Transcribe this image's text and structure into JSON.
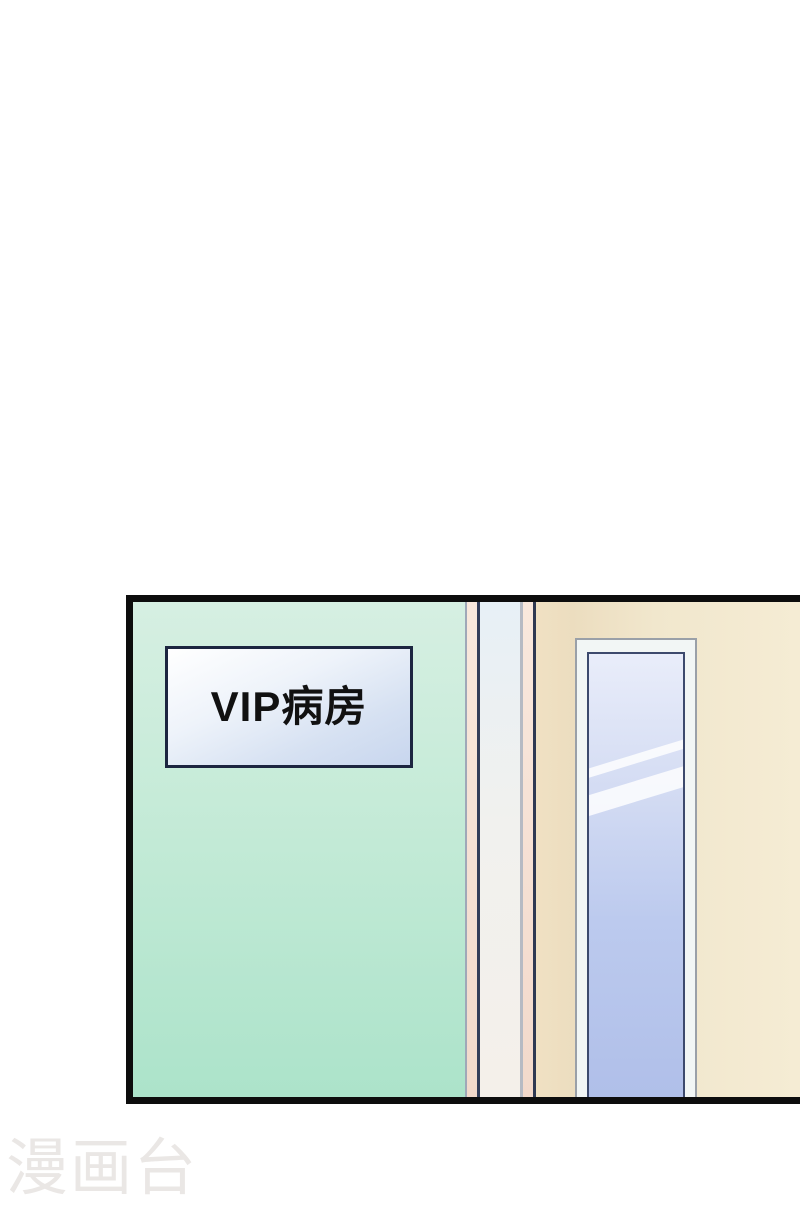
{
  "panel": {
    "type": "manga-panel",
    "scene": "hospital corridor with ward door",
    "border_color": "#0d0d0d",
    "wall": {
      "color_top": "#d6efe2",
      "color_bottom": "#ace3ca"
    },
    "sign": {
      "text": "VIP病房",
      "text_color": "#111111",
      "border_color": "#1c2540",
      "bg_top": "#ffffff",
      "bg_bottom": "#c8d6ee"
    },
    "door_frame": {
      "pink_strip_color": "#f5e0d3",
      "navy_strip_color": "#333d59",
      "white_strip_color": "#f1f1ee",
      "gray_line_color": "#b6bac3"
    },
    "door": {
      "tan_left": "#f0e1c3",
      "tan_right": "#f5ecd4"
    },
    "window": {
      "frame_color": "#f2f6f5",
      "outline_color": "#9aa0a8",
      "glass_border_color": "#3d4a6d",
      "glass_top": "#e9edfa",
      "glass_bottom": "#b0bfe9",
      "highlight_color": "#ffffff"
    }
  },
  "watermark": {
    "text": "漫画台",
    "color": "#eae7e5"
  }
}
